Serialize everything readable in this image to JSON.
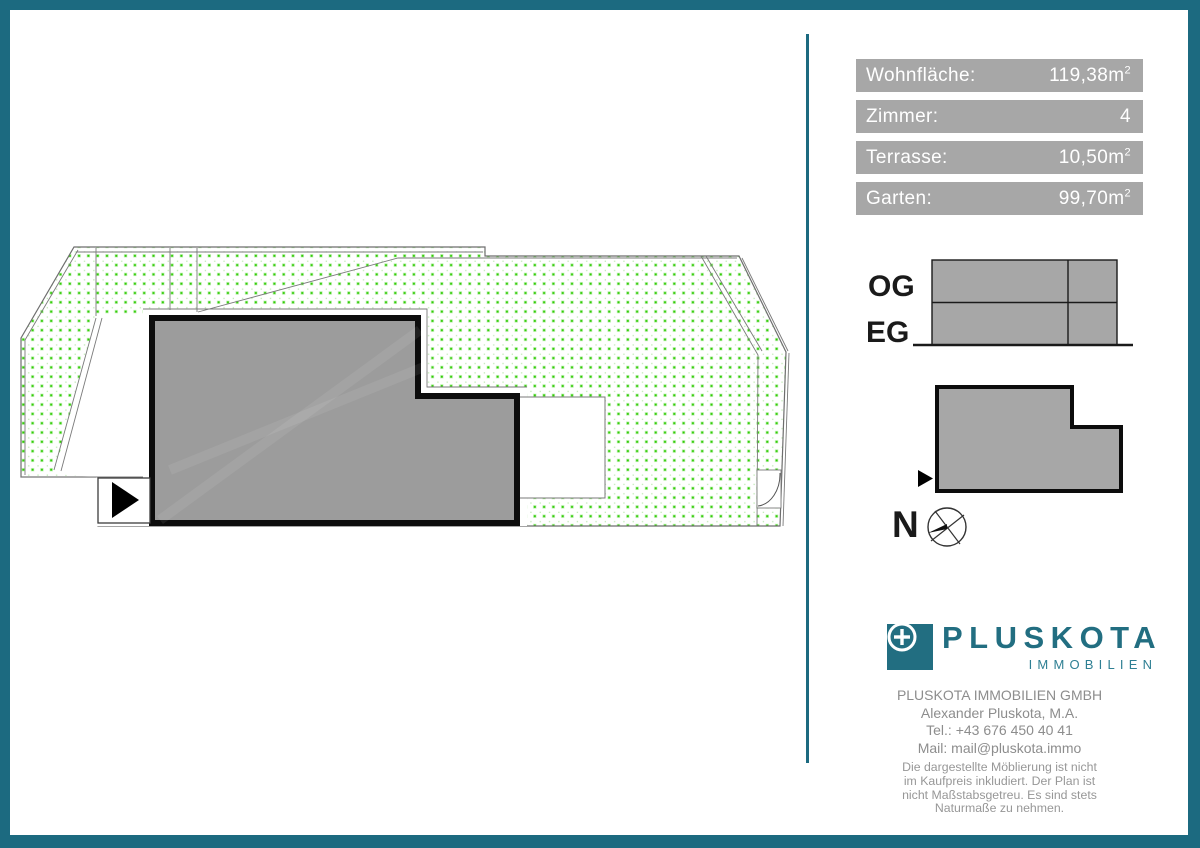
{
  "colors": {
    "frame_teal": "#1c6a80",
    "logo_teal": "#226e81",
    "bar_gray": "#a7a7a7",
    "building_gray": "#9c9c9c",
    "diagram_gray": "#a7a7a7",
    "garden_dot_green": "#31cc06",
    "contact_gray": "#8d8d8d"
  },
  "info_panel": {
    "rows": [
      {
        "label": "Wohnfläche:",
        "value": "119,38m",
        "sup": "2"
      },
      {
        "label": "Zimmer:",
        "value": "4",
        "sup": ""
      },
      {
        "label": "Terrasse:",
        "value": "10,50m",
        "sup": "2"
      },
      {
        "label": "Garten:",
        "value": "99,70m",
        "sup": "2"
      }
    ]
  },
  "floor_diagram": {
    "upper_floor_label": "OG",
    "ground_floor_label": "EG"
  },
  "compass": {
    "north_label": "N"
  },
  "logo": {
    "name": "PLUSKOTA",
    "subtitle": "IMMOBILIEN"
  },
  "contact": {
    "lines": [
      "PLUSKOTA IMMOBILIEN GMBH",
      "Alexander Pluskota, M.A.",
      "Tel.: +43 676 450 40 41",
      "Mail: mail@pluskota.immo"
    ]
  },
  "disclaimer": {
    "lines": [
      "Die dargestellte Möblierung ist nicht",
      "im Kaufpreis inkludiert. Der Plan ist",
      "nicht Maßstabsgetreu. Es sind stets",
      "Naturmaße zu nehmen."
    ]
  }
}
